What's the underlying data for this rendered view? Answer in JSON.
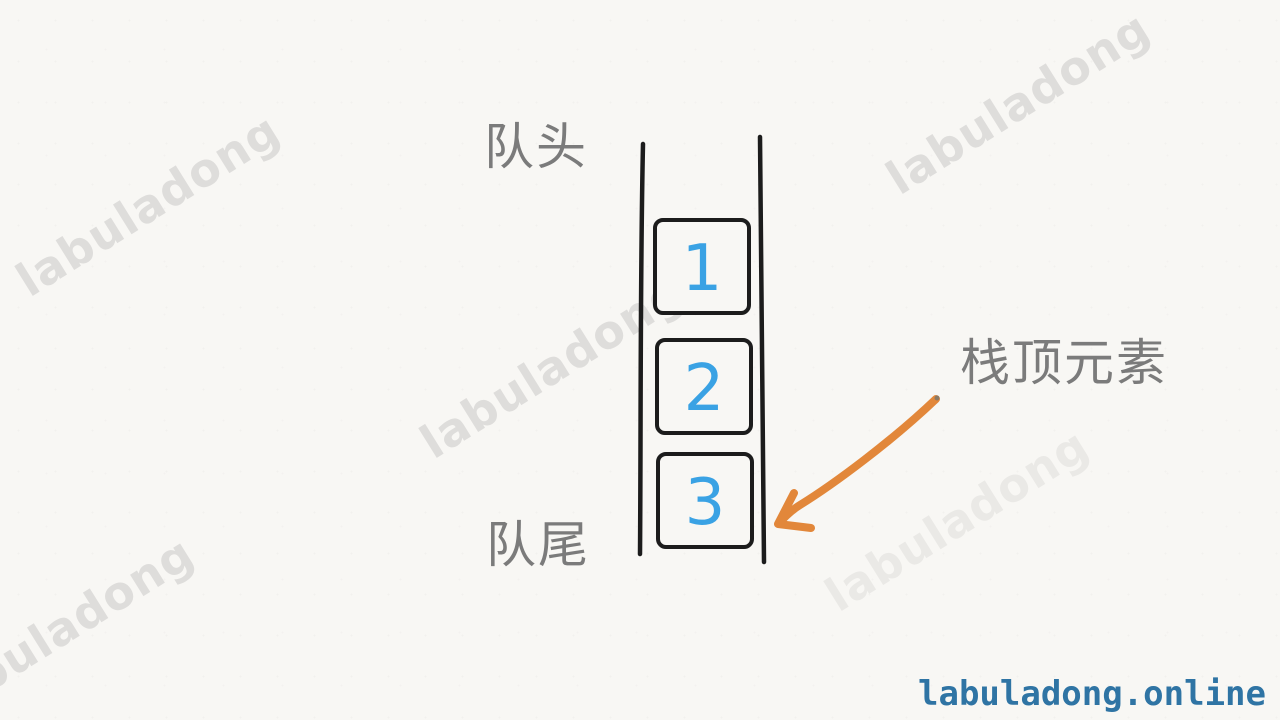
{
  "page": {
    "background_color": "#f8f7f4"
  },
  "watermark": {
    "text": "labuladong",
    "color": "#dedddb"
  },
  "diagram": {
    "queue_head_label": "队头",
    "queue_tail_label": "队尾",
    "stack_top_label": "栈顶元素",
    "cells": [
      {
        "value": "1"
      },
      {
        "value": "2"
      },
      {
        "value": "3"
      }
    ],
    "colors": {
      "channel_line": "#1c1c1c",
      "cell_border": "#1c1c1c",
      "cell_number": "#3aa2e4",
      "label_text": "#7b7b7b",
      "arrow": "#e2873a"
    }
  },
  "footer": {
    "text": "labuladong.online",
    "color": "#2f74a4"
  }
}
